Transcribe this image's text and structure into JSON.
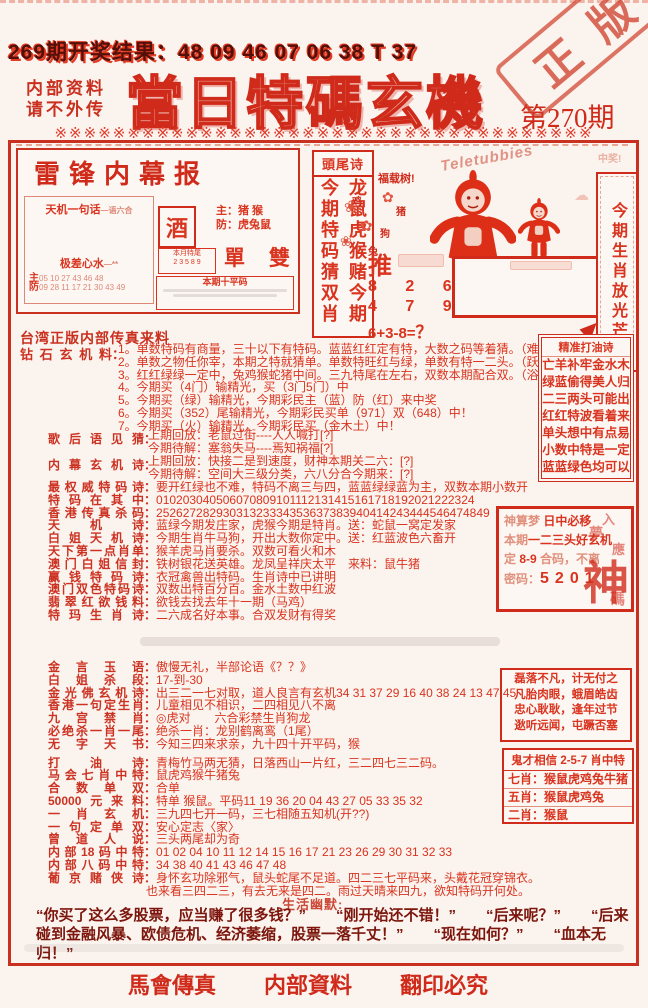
{
  "ui": {
    "colon": "："
  },
  "colors": {
    "accent": "#cf2a1a",
    "text": "#d9341f",
    "dark_text": "#7c150c"
  },
  "header": {
    "result_line": "269期开奖结果：48 09 46 07 06 38 T 37",
    "note1": "内部资料",
    "note2": "请不外传",
    "title": "當日特碼玄機",
    "issue": "第270期",
    "stamp": "正版",
    "deco": "※※※※※※※※※※※※※※※※※※※※※※※※※※※※※※※※※※※※※"
  },
  "leifeng": {
    "title": "雷锋内幕报",
    "tianji_label": "天机一句话",
    "tianji_sub": "—语六合",
    "jicha_label": "极差心水",
    "jicha_sub": "—**",
    "zhu_label": "主",
    "zhu_nums": "05 10 27 43 46 48",
    "fang_label": "防",
    "fang_nums": "09 28 11 17 21 30 43 49",
    "main_zhu": "主：猪 猴",
    "main_fang": "防：虎兔鼠",
    "jiu": "酒",
    "dan_shuang": "單 雙",
    "tail_title": "本月特尾",
    "tail_nums": "2 3 5 8 9",
    "ping_title": "本期十平码"
  },
  "middle": {
    "poem_box_title": "頭尾诗",
    "poem_col_right": "龙鼠虎猴赌今期",
    "poem_col_left": "今期特码猜双肖",
    "tree_label": "福载树!",
    "tree_char1": "鸡",
    "tree_char2": "猪",
    "tree_char3": "狗",
    "tree_char4": "兔",
    "push": "推",
    "nums1": "8 2 6",
    "nums2": "4 7 9",
    "formula": "6+3-8=",
    "formula_q": "？",
    "teletubbies": "Teletubbies",
    "win_note": "中奖!",
    "vertical_slogan": "今期生肖放光芒"
  },
  "s1": {
    "source": "台湾正版内部传真来料",
    "diamond_label": "钻石玄机料",
    "diamond_lines": [
      "1。单数特码有商量，三十以下有特码。蓝蓝红红定有特，大数之码等着猜。（难）",
      "2。单数之物任你宰，本期之特就猜单。单数特旺红与绿，单数有特一二头。（跃）",
      "3。红红绿绿一定中，兔鸡猴蛇猪中间。三九特尾在左右，双数本期配合双。（浴）",
      "4。今期买（4门）输精光，买（3门5门）中",
      "5。今期买（绿）输精光，今期彩民主（蓝）防（红）来中奖",
      "6。今期买（352）尾输精光，今期彩民买单（971）双（648）中！",
      "7。今期买（火）输精光，今期彩民买（金木土）中！"
    ],
    "song_label": "歌后语见猜",
    "song_lines": [
      "上期回放：老鼠过街----人人喊打[?]",
      "今期待解：塞翁失马----焉知祸福[?]"
    ],
    "inside_label": "内幕玄机诗",
    "inside_lines": [
      "上期回放：快接二是到速度，财神本期关二六：[?]",
      "今期待解：空间大三级分类，六八分合今期来：[?]"
    ],
    "rows": [
      {
        "label": "最权威特码诗",
        "text": "要开红绿也不难，特码不离三与四，蓝蓝绿绿蓝为主，双数本期小数开"
      },
      {
        "label": "特码在其中",
        "text": "010203040506070809101112131415161718192021222324"
      },
      {
        "label": "香港传真杀码",
        "text": "25262728293031323334353637383940414243444546474849"
      },
      {
        "label": "天机诗",
        "text": "蓝绿今期发庄家，虎猴今期是特肖。送：蛇鼠一窝定发家"
      },
      {
        "label": "白姐天机诗",
        "text": "今期生肖牛马狗，开出大数你定中。送：红蓝波色六畜开"
      },
      {
        "label": "天下第一点肖单",
        "text": "猴羊虎马肖要杀。双数可看火和木"
      },
      {
        "label": "澳门白姐信封",
        "text": "铁树银花送英雄。龙凤呈祥庆太平　来料：鼠牛猪"
      },
      {
        "label": "赢钱特码诗",
        "text": "衣冠禽兽出特码。生肖诗中已讲明"
      },
      {
        "label": "澳门双色特码诗",
        "text": "双数出特百分百。金水土数中红波"
      },
      {
        "label": "翡翠红欲钱料",
        "text": "欲钱去找去年十一期（马鸡）"
      },
      {
        "label": "特玛生肖诗",
        "text": "二六成名好本事。合双发财有得奖"
      }
    ]
  },
  "rb": {
    "oil": {
      "title": "精准打油诗",
      "lines": [
        "亡羊补牢金水木",
        "绿蓝偷得美人归",
        "二三两头可能出",
        "红红特波看着来",
        "单头想中有点易",
        "小数中特是一定",
        "蓝蓝绿色均可以"
      ]
    },
    "dream": {
      "l1a": "神算梦",
      "l1b": "日中必移",
      "l2a": "本期",
      "l2b": "一二三头好玄机",
      "l3a": "定",
      "l3b": "8-9",
      "l3c": "合码，不离",
      "l4a": "密码：",
      "l4b": "5201",
      "wm1": "入",
      "wm2": "夢",
      "wm3": "應",
      "wm_big": "神",
      "wm_small": "碼"
    },
    "idiom": {
      "lines": [
        "磊落不凡，计无付之",
        "凡胎肉眼，蛾眉皓齿",
        "忠心耿耿，逢年过节",
        "逖听远闻，屯蹶否塞"
      ]
    },
    "ghost": {
      "title": "鬼才相信 2-5-7 肖中特",
      "lines": [
        "七肖：猴鼠虎鸡兔牛猪",
        "五肖：猴鼠虎鸡兔",
        "二肖：猴鼠"
      ]
    }
  },
  "s2": {
    "rows": [
      {
        "label": "金言玉语",
        "text": "傲慢无礼，半部论语《？？》"
      },
      {
        "label": "白姐杀段",
        "text": "17-到-30"
      },
      {
        "label": "金光佛玄机诗",
        "text": "出三二一七对取，道人良言有玄机34 31 37 29 16 40 38 24 13 47 45"
      },
      {
        "label": "香港一句定生肖",
        "text": "儿童相见不相识，二四相见八不离"
      },
      {
        "label": "九宫禁肖",
        "text": "◎虎对　　六合彩禁生肖狗龙"
      },
      {
        "label": "必绝杀一肖一尾",
        "text": "绝杀一肖：龙别鹤离鸾（1尾）"
      },
      {
        "label": "无字天书",
        "text": "今知三四来求亲，九十四十开平码，猴"
      },
      {
        "label": "打油诗",
        "text": "青梅竹马两无猜，日落西山一片红，三二四七三二码。"
      },
      {
        "label": "马会七肖中特",
        "text": "鼠虎鸡猴牛猪兔"
      },
      {
        "label": "合数单双",
        "text": "合单"
      },
      {
        "label": "50000元来料",
        "text": "特单 猴鼠。平码11 19 36 20 04 43 27 05 33 35 32"
      },
      {
        "label": "一肖玄机",
        "text": "三九四七开一码，三七相随五知机(开??)"
      },
      {
        "label": "一句定单双",
        "text": "安心定志〈家〉"
      },
      {
        "label": "曾道人说",
        "text": "三头两尾却为奇"
      },
      {
        "label": "内部18码中特",
        "text": "01 02 04 10 11 12 14 15 16 17 21 23 26 29 30 31 32 33"
      },
      {
        "label": "内部八码中特",
        "text": "34 38 40 41 43 46 47 48"
      },
      {
        "label": "葡京赌侠诗",
        "text": "身怀玄功除邪气，鼠头蛇尾不足道。四二三七平码来，头戴花冠穿锦衣。"
      }
    ],
    "pujing_line2": "也来看三四二三，有去无来是四二。雨过天晴来四九，欲知特码开何处。"
  },
  "humor": {
    "label": "生活幽默:",
    "text": "“你买了这么多股票，应当赚了很多钱？”　　“刚开始还不错！”　　“后来呢？”　　“后来碰到金融风暴、欧债危机、经济萎缩，股票一落千丈！”　　“现在如何？”　　“血本无归！”"
  },
  "footer": {
    "item1": "馬會傳真",
    "item2": "内部資料",
    "item3": "翻印必究"
  }
}
